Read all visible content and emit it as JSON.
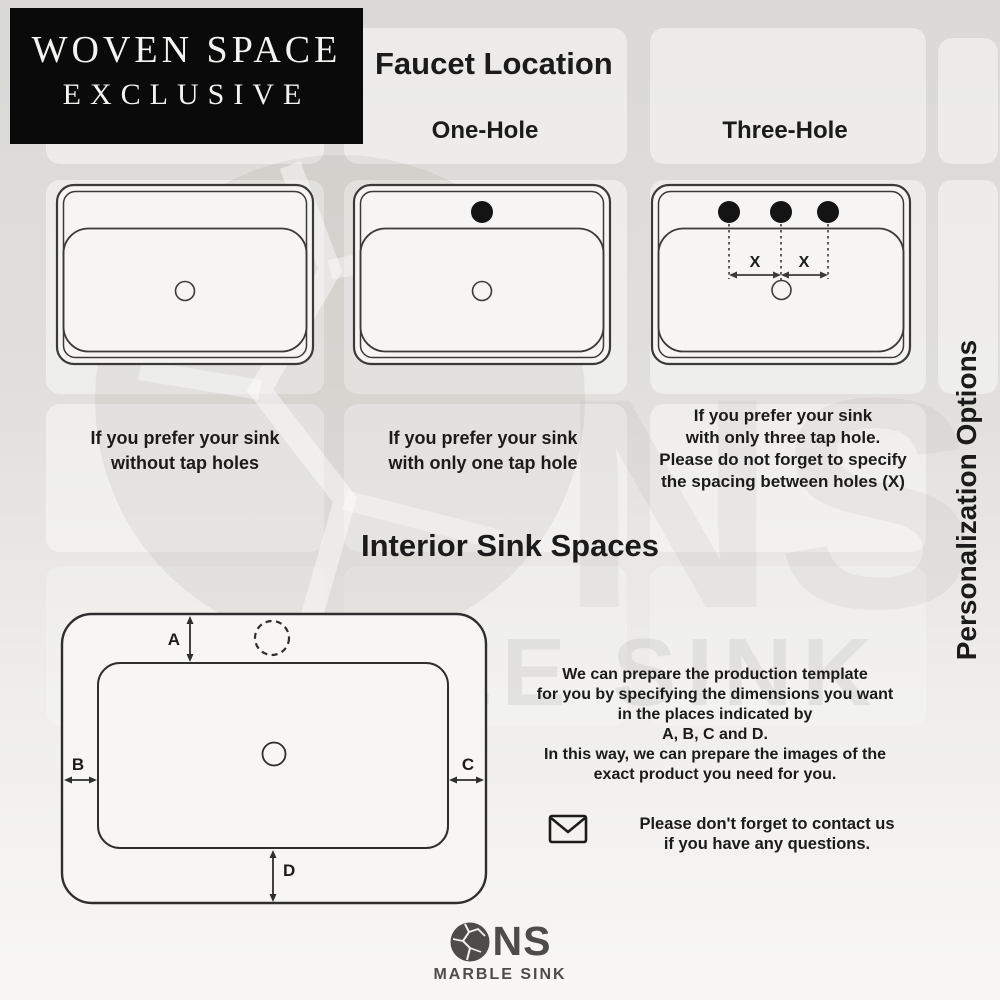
{
  "brand_badge": {
    "line1": "WOVEN SPACE",
    "line2": "EXCLUSIVE"
  },
  "faucet_section": {
    "title": "Faucet Location",
    "columns": {
      "one_hole": "One-Hole",
      "three_hole": "Three-Hole"
    },
    "captions": {
      "no_hole": [
        "If you prefer your sink",
        "without tap holes"
      ],
      "one_hole": [
        "If you prefer your sink",
        "with only one tap hole"
      ],
      "three_hole": [
        "If you prefer your sink",
        "with only three tap hole.",
        "Please do not forget to specify",
        "the spacing between holes (X)"
      ]
    },
    "spacing_label": "X"
  },
  "interior_section": {
    "title": "Interior Sink Spaces",
    "dims": {
      "a": "A",
      "b": "B",
      "c": "C",
      "d": "D"
    },
    "description": [
      "We can prepare the production template",
      "for you by specifying the dimensions you want",
      "in the places indicated by",
      "A, B, C and D.",
      "In this way, we can prepare the images of the",
      "exact product you need for you."
    ],
    "contact": [
      "Please don't forget to contact us",
      "if you have any questions."
    ]
  },
  "side_label": "Personalization Options",
  "footer_logo": {
    "name": "NS",
    "subtitle": "MARBLE SINK"
  },
  "watermark": {
    "ball_text": "NS",
    "text": "MARBLE SINK"
  },
  "colors": {
    "ink": "#1b1b1b",
    "line": "#3a3a3a",
    "badge_bg": "#0a0a0a",
    "badge_text": "#f5f3ef",
    "logo_gray": "#4e4b48",
    "hole_fill": "#141414"
  }
}
